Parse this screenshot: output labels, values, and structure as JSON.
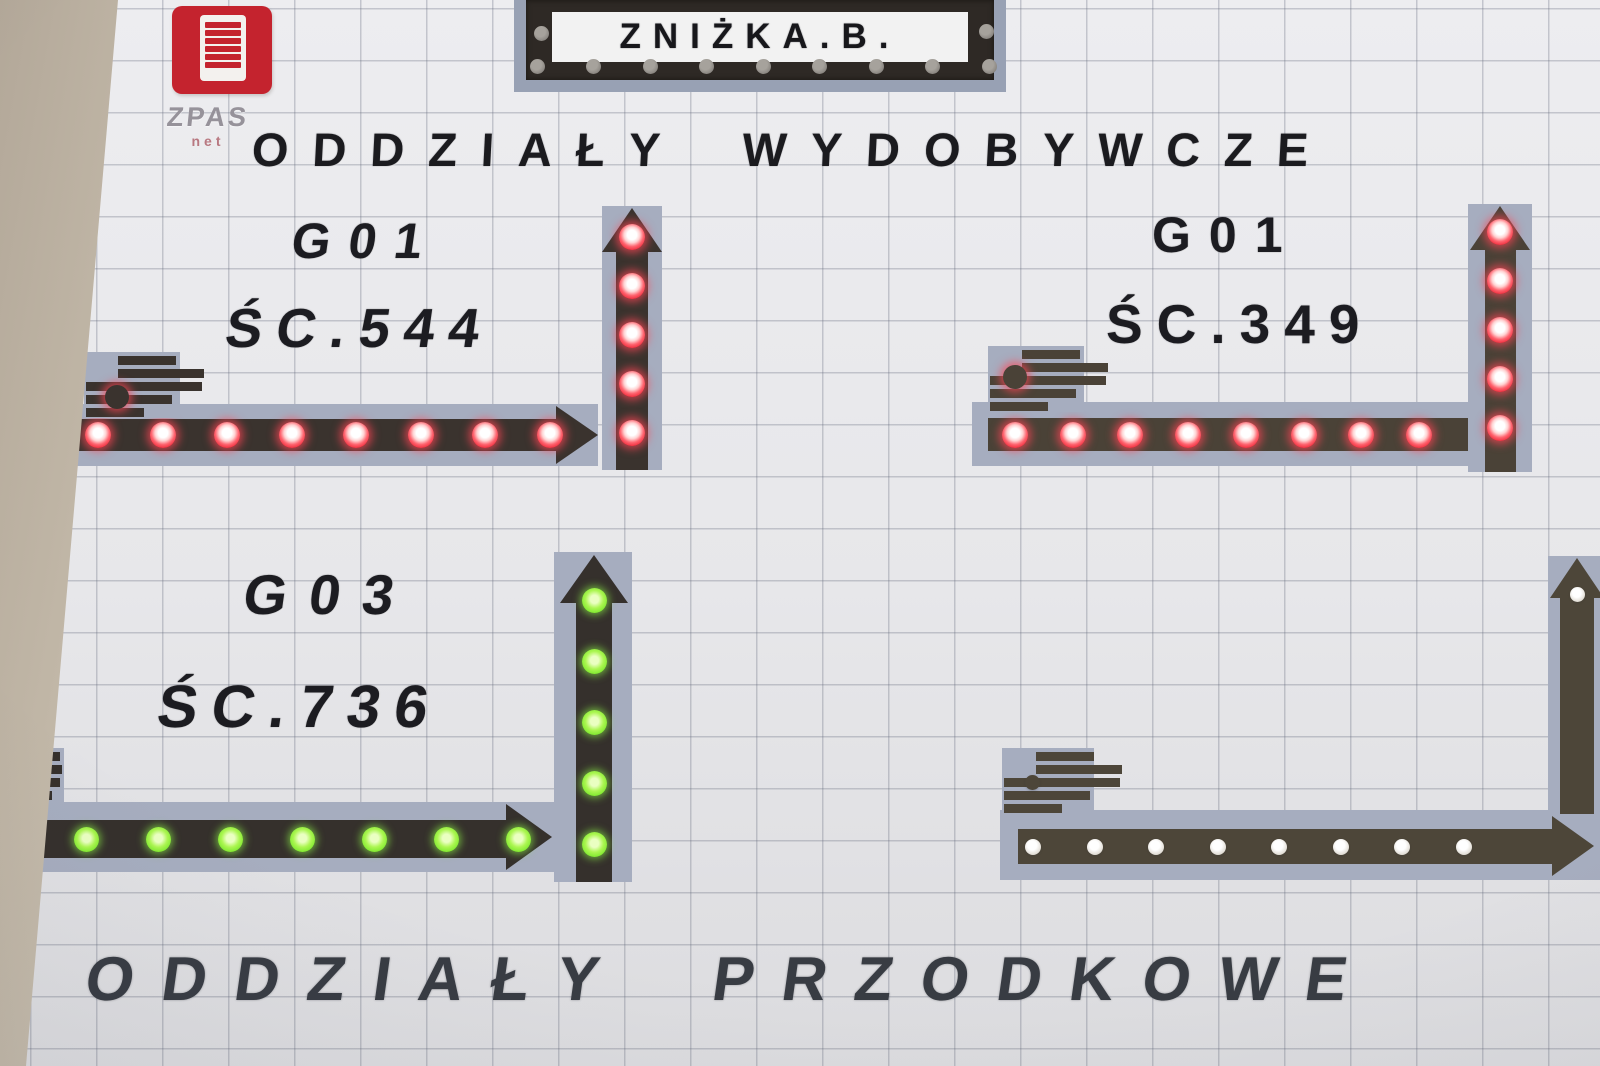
{
  "logo": {
    "brand": "ZPAS",
    "sub": "net"
  },
  "sign": {
    "text": "ZNIŻKA.B.",
    "unlit_led_count": 11
  },
  "titles": {
    "top": "ODDZIAŁY WYDOBYWCZE",
    "bottom": "ODDZIAŁY PRZODKOWE"
  },
  "colors": {
    "led_red": "#ee2536",
    "led_green": "#7fe92f",
    "led_unlit": "#e4e0d9",
    "band": "#a6adbf",
    "arrow_dark": "#3a332e",
    "arrow_olive": "#4a4237",
    "logo_red": "#c4232e",
    "tile": "#e7e7ea"
  },
  "sections": [
    {
      "id": "sc-544",
      "group": "G01",
      "face": "ŚC.544",
      "led_color": "red",
      "status": "active",
      "horizontal_led_count": 8,
      "vertical_led_count": 5,
      "block_led_count": 1
    },
    {
      "id": "sc-349",
      "group": "G01",
      "face": "ŚC.349",
      "led_color": "red",
      "status": "active",
      "horizontal_led_count": 8,
      "vertical_led_count": 5,
      "block_led_count": 1
    },
    {
      "id": "sc-736",
      "group": "G03",
      "face": "ŚC.736",
      "led_color": "green",
      "status": "active",
      "horizontal_led_count": 8,
      "vertical_led_count": 5,
      "block_led_count": 1
    },
    {
      "id": "unlabeled",
      "group": "",
      "face": "",
      "led_color": "unlit",
      "status": "inactive",
      "horizontal_led_count": 8,
      "vertical_led_count": 1,
      "block_led_count": 1
    }
  ]
}
